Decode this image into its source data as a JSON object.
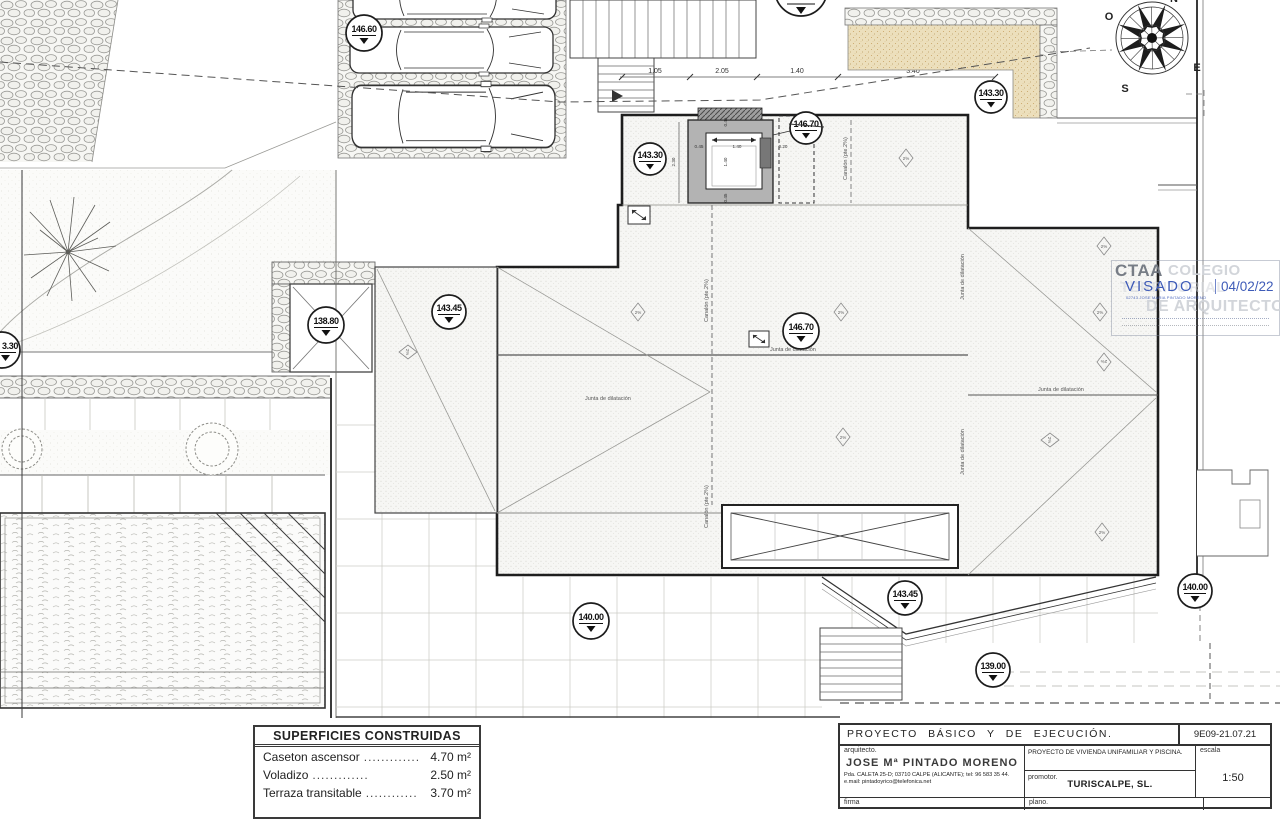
{
  "levels": {
    "driveway": "146.60",
    "elevator_left": "143.30",
    "elevator_right": "146.70",
    "top_right": "143.30",
    "patio": "138.80",
    "terrace_left": "143.45",
    "roof_center": "146.70",
    "terrace_bottom": "140.00",
    "roof_edge": "143.45",
    "garden_bottom": "139.00",
    "right_edge": "140.00",
    "left_edge_cut": "3.30"
  },
  "dims": {
    "top1": "1.05",
    "top2": "2.05",
    "top3": "1.40",
    "top4": "3.40",
    "w_left": "0.45",
    "w_mid": "1.40",
    "w_right": "0.20",
    "h_total": "2.30",
    "h_top": "0.45",
    "h_mid": "1.40",
    "h_bottom": "0.45"
  },
  "labels": {
    "junta": "Junta de dilatación",
    "canalon": "Canalón (pte.2%)",
    "slope": "2%"
  },
  "compass": {
    "n": "N",
    "s": "S",
    "e": "E",
    "o": "O"
  },
  "stamp": {
    "acronym": "CTAA",
    "word1": "COLEGIO",
    "word2": "TERRITORIAL",
    "word3": "DE ARQUITECTOS",
    "visado": "VISADO",
    "date": "04/02/22",
    "sub": "02743 JOSE MARIA PINTADO MORENO"
  },
  "areas_table": {
    "header": "SUPERFICIES CONSTRUIDAS",
    "rows": [
      {
        "label": "Caseton ascensor",
        "dots": ".............",
        "value": "4.70 m²"
      },
      {
        "label": "Voladizo",
        "dots": ".............",
        "value": "2.50 m²"
      },
      {
        "label": "Terraza transitable",
        "dots": "............",
        "value": "3.70 m²"
      }
    ]
  },
  "title_block": {
    "project_type": "PROYECTO BÁSICO Y DE EJECUCIÓN.",
    "code": "9E09-21.07.21",
    "architect_label": "arquitecto.",
    "architect_name": "JOSE Mª PINTADO MORENO",
    "architect_address": "Pda. CALETA 25-D; 03710 CALPE (ALICANTE); tel: 96 583 35 44.",
    "architect_email": "e.mail: pintadoyrico@telefonica.net",
    "project_title": "PROYECTO DE VIVIENDA UNIFAMILIAR Y PISCINA.",
    "promoter_label": "promotor.",
    "promoter_name": "TURISCALPE, SL.",
    "scale_label": "escala",
    "scale_value": "1:50",
    "signature_label": "firma",
    "plan_label": "plano."
  }
}
